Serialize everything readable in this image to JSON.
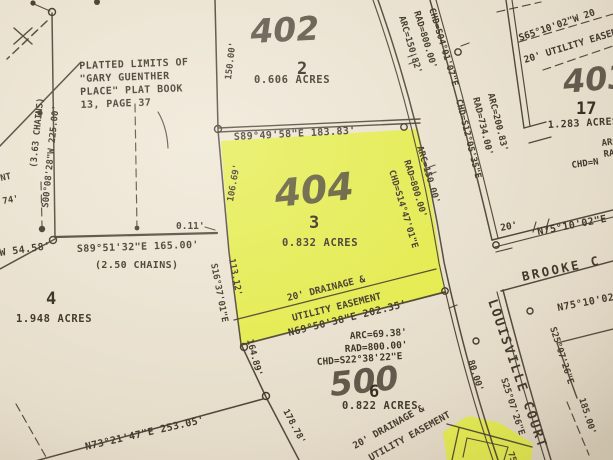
{
  "colors": {
    "paper": "#e8dfcd",
    "ink": "#3f362a",
    "highlight": "#e2ee2e"
  },
  "plat_note": {
    "lines": [
      "PLATTED LIMITS OF",
      "\"GARY GUENTHER",
      "PLACE\" PLAT BOOK",
      "13, PAGE 37"
    ]
  },
  "streets": {
    "louisville": "LOUISVILLE COURT",
    "brooke": "BROOKE C"
  },
  "lots": {
    "lot2": {
      "house_number": "402",
      "lot_number": "2",
      "area": "0.606 ACRES"
    },
    "lot3": {
      "house_number": "404",
      "lot_number": "3",
      "area": "0.832 ACRES"
    },
    "lot4": {
      "lot_number": "4",
      "area": "1.948 ACRES"
    },
    "lot6": {
      "house_number": "500",
      "lot_number": "6",
      "area": "0.822 ACRES"
    },
    "lot17": {
      "house_number": "403",
      "lot_number": "17",
      "area": "1.283 ACRES"
    }
  },
  "easements": {
    "center": [
      "20' DRAINAGE &",
      "UTILITY EASEMENT"
    ],
    "southeast": [
      "20' DRAINAGE &",
      "UTILITY EASEMENT"
    ],
    "northeast": "20' UTILITY EASEMENT",
    "left_edge_fragment": "NT"
  },
  "bearings": {
    "lot3_north": "S89°49'58\"E 183.83'",
    "lot4_north": "S89°51'32\"E 165.00'",
    "lot4_north_chains": "(2.50 CHAINS)",
    "plat_east": "S00°08'28\"W 225.00'",
    "plat_east_chains": "(3.63 CHAINS)",
    "lot3_south": "N69°50'38\"E 202.35'",
    "bottom_line": "N73°21'47\"E 253.05'",
    "lot3_west": "S16°37'01\"E",
    "northeast_line": "S65°10'02\"W 20",
    "brooke_north": "N75°10'02\"E",
    "brooke_south": "N75°10'02\"E",
    "louisville_west": "S25°07'26\"E",
    "louisville_east": "S25°07'26\"E",
    "west_fragment": "W 54.58'"
  },
  "distances": {
    "lot2_west": "150.00'",
    "lot3_west_upper": "106.69'",
    "lot3_west_113": "113.12'",
    "lot6_west_164": "164.89'",
    "lot6_west_178": "178.78'",
    "gap": "0.11'",
    "louisville_80": "80.00'",
    "louisville_185": "185.00'",
    "brooke_width": "20'",
    "left_edge_74": "74'",
    "se_lot_75": "75."
  },
  "curves": {
    "lot2_frontage": {
      "arc": "ARC=150.82'",
      "rad": "RAD=800.00'",
      "chd": "CHD=S04°01'07\"E"
    },
    "lot3_frontage": {
      "arc": "ARC=150.00'",
      "rad": "RAD=800.00'",
      "chd": "CHD=S14°47'01\"E"
    },
    "east_row": {
      "arc": "ARC=200.83'",
      "rad": "RAD=734.00'",
      "chd": "CHD=S12°05'35\"E"
    },
    "lot6_frontage": {
      "arc": "ARC=69.38'",
      "rad": "RAD=800.00'",
      "chd": "CHD=S22°38'22\"E"
    },
    "lot17_edge_fragments": {
      "arc": "ARC=",
      "rad": "RAD=",
      "chd": "CHD=N"
    }
  }
}
